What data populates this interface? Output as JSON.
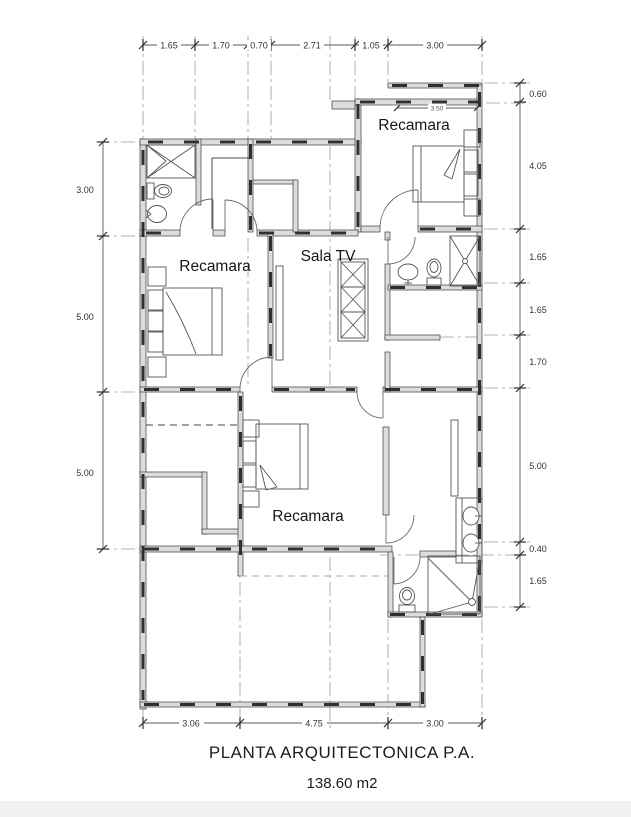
{
  "title": {
    "main": "PLANTA ARQUITECTONICA P.A.",
    "area": "138.60 m2"
  },
  "labels": {
    "bedroom_top": "Recamara",
    "bedroom_left": "Recamara",
    "bedroom_bottom": "Recamara",
    "sala_tv": "Sala TV"
  },
  "dims": {
    "top": [
      "1.65",
      "1.70",
      "0.70",
      "2.71",
      "1.05",
      "3.00"
    ],
    "bottom": [
      "3.06",
      "4.75",
      "3.00"
    ],
    "left": [
      "3.00",
      "5.00",
      "5.00"
    ],
    "right": [
      "0.60",
      "4.05",
      "1.65",
      "1.65",
      "1.70",
      "5.00",
      "0.40",
      "1.65"
    ],
    "interior": "3.50"
  },
  "colors": {
    "wall_fill": "#dcdcdc",
    "line": "#3d3d3d",
    "centerline": "#9a9a9a",
    "text": "#1d1d1d"
  }
}
